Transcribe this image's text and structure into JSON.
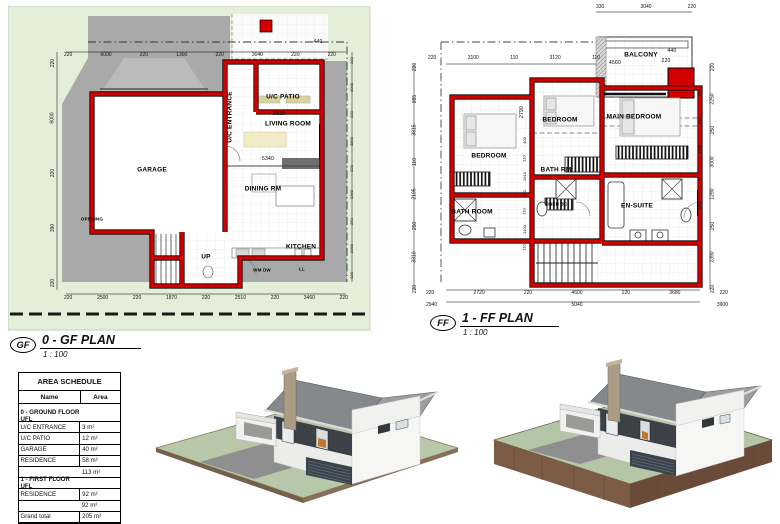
{
  "colors": {
    "wall_red": "#d40000",
    "site_green": "#e4efda",
    "paving_gray": "#a9a9a9",
    "roof_gray": "#85888c",
    "accent_charcoal": "#3c4147",
    "lawn_green": "#b7c7aa",
    "earth_brown": "#7d5c46"
  },
  "gf_plan": {
    "badge": "GF",
    "title": "0 - GF PLAN",
    "scale": "1 : 100",
    "rooms": {
      "garage": "GARAGE",
      "entrance": "U/C ENTRANCE",
      "patio": "U/C PATIO",
      "living": "LIVING ROOM",
      "dining": "DINING RM",
      "kitchen": "KITCHEN"
    },
    "labels": {
      "up": "UP",
      "opening": "OPENING",
      "wm_dw": "WM DW",
      "ll": "LL"
    },
    "dims": {
      "top": [
        "220",
        "6000",
        "220",
        "1300",
        "220",
        "3040",
        "220",
        "220"
      ],
      "d440": "440",
      "bottom": [
        "220",
        "2500",
        "220",
        "1870",
        "220",
        "2510",
        "220",
        "3460",
        "220"
      ],
      "left": [
        "220",
        "6000",
        "220",
        "390",
        "220"
      ],
      "right": [
        "220",
        "3000",
        "220",
        "3890",
        "220",
        "2390",
        "250",
        "2090",
        "220"
      ],
      "d3920": "3920",
      "d5340": "5340"
    }
  },
  "ff_plan": {
    "badge": "FF",
    "title": "1 - FF PLAN",
    "scale": "1 : 100",
    "rooms": {
      "bedroom_left": "BEDROOM",
      "bedroom_mid": "BEDROOM",
      "main_bedroom": "MAIN BEDROOM",
      "bath_rm": "BATH RM",
      "bath_room": "BATH ROOM",
      "en_suite": "EN-SUITE",
      "balcony": "BALCONY",
      "linen": "LINEN BC"
    },
    "dims": {
      "top_outer": [
        "330",
        "3040",
        "220"
      ],
      "top": [
        "220",
        "3100",
        "110",
        "3120",
        "110"
      ],
      "balcony_w": "4560",
      "balcony_d440": "440",
      "balcony_d220": "220",
      "bottom": [
        "220",
        "2720",
        "220",
        "4600",
        "220",
        "3680",
        "220"
      ],
      "bottom_totals": [
        "2940",
        "5040",
        "3900"
      ],
      "left": [
        "220",
        "895",
        "3815",
        "110",
        "2195",
        "250",
        "3310",
        "220"
      ],
      "right": [
        "220",
        "2250",
        "250",
        "3000",
        "1290",
        "250",
        "2390",
        "220"
      ],
      "right_inner": [
        "600",
        "110",
        "1000",
        "110",
        "1000"
      ],
      "center": [
        "400",
        "110",
        "1910",
        "400",
        "110",
        "1100",
        "110"
      ],
      "d2790": "2790"
    }
  },
  "area_schedule": {
    "title": "AREA SCHEDULE",
    "columns": {
      "name": "Name",
      "area": "Area"
    },
    "rows": [
      {
        "_class": "section",
        "name": "0 - GROUND FLOOR UFL",
        "area": ""
      },
      {
        "_class": "item",
        "name": "U/C ENTRANCE",
        "area": "3 m²"
      },
      {
        "_class": "item",
        "name": "U/C PATIO",
        "area": "12 m²"
      },
      {
        "_class": "item",
        "name": "GARAGE",
        "area": "40 m²"
      },
      {
        "_class": "item",
        "name": "RESIDENCE",
        "area": "58 m²"
      },
      {
        "_class": "subtotal",
        "name": "",
        "area": "113 m²"
      },
      {
        "_class": "section",
        "name": "1 - FIRST FLOOR UFL",
        "area": ""
      },
      {
        "_class": "item",
        "name": "RESIDENCE",
        "area": "92 m²"
      },
      {
        "_class": "subtotal",
        "name": "",
        "area": "92 m²"
      },
      {
        "_class": "grand",
        "name": "Grand total",
        "area": "205 m²"
      }
    ]
  }
}
